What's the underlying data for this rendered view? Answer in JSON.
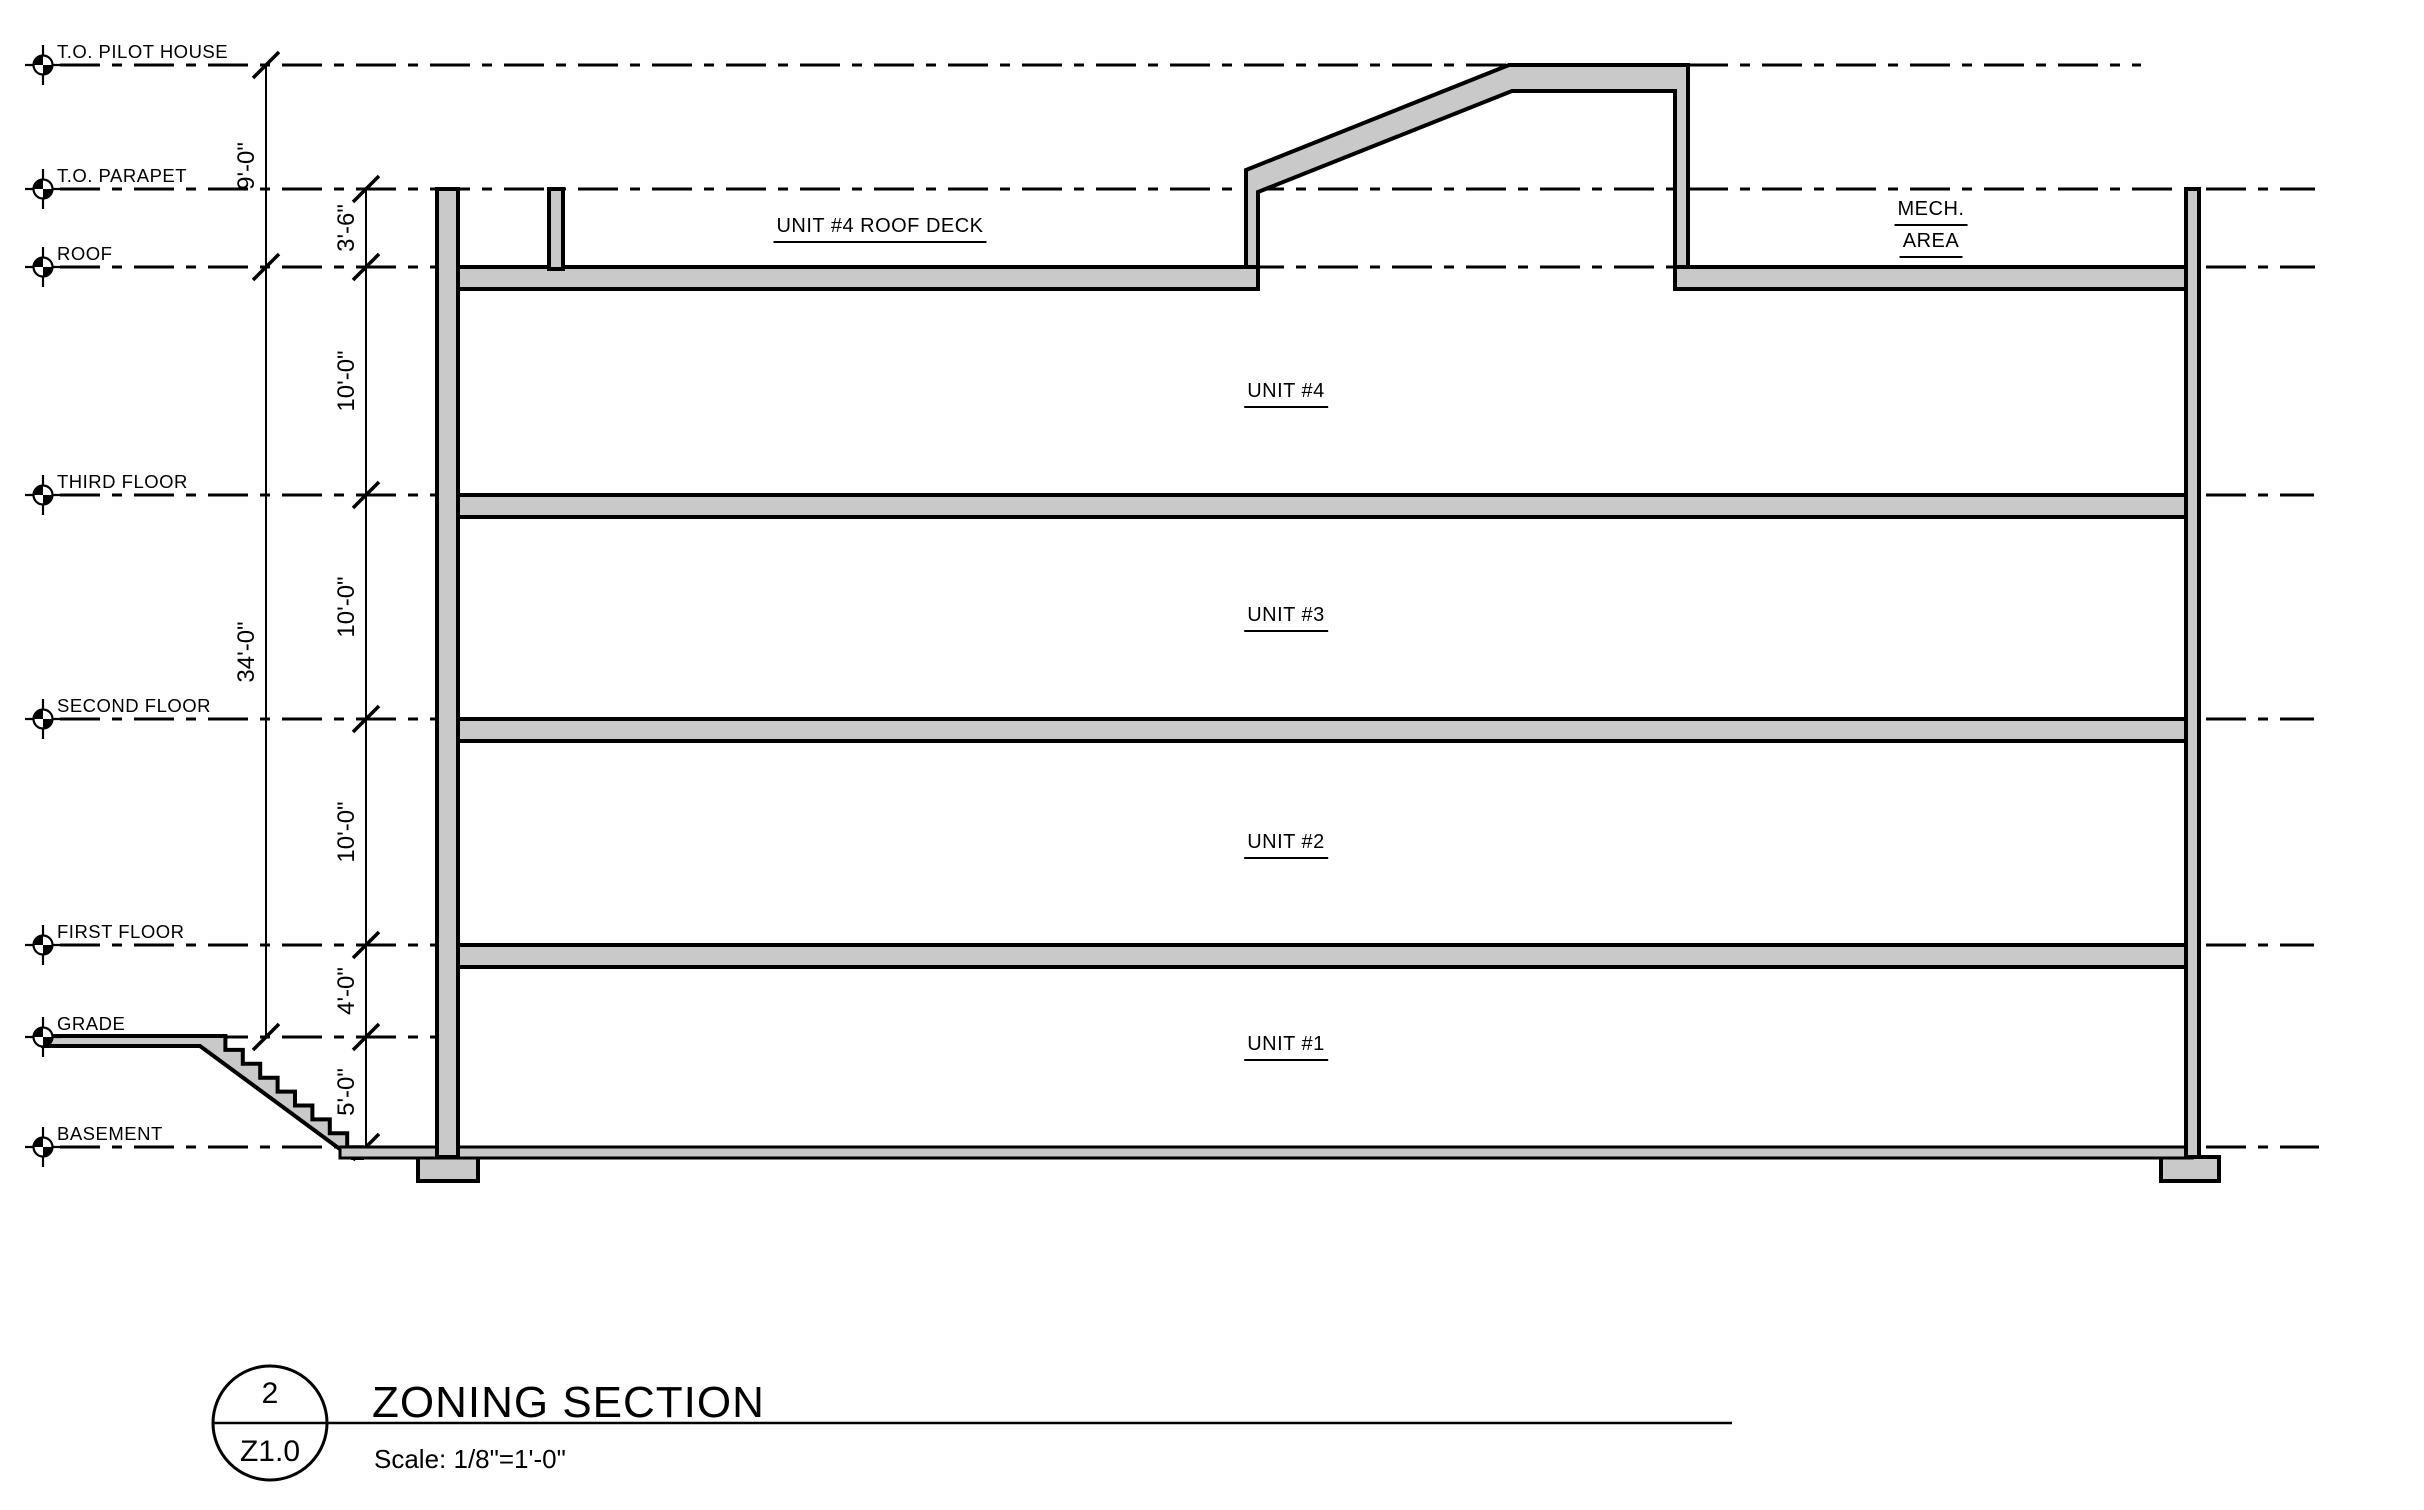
{
  "drawing": {
    "levels": [
      {
        "label": "T.O. PILOT HOUSE"
      },
      {
        "label": "T.O. PARAPET"
      },
      {
        "label": "ROOF"
      },
      {
        "label": "THIRD FLOOR"
      },
      {
        "label": "SECOND FLOOR"
      },
      {
        "label": "FIRST FLOOR"
      },
      {
        "label": "GRADE"
      },
      {
        "label": "BASEMENT"
      }
    ],
    "dimensions": {
      "roof_to_pilot_house": "9'-0\"",
      "grade_to_roof": "34'-0\"",
      "roof_to_parapet": "3'-6\"",
      "third_to_roof": "10'-0\"",
      "second_to_third": "10'-0\"",
      "first_to_second": "10'-0\"",
      "grade_to_first": "4'-0\"",
      "basement_to_grade": "5'-0\""
    },
    "rooms": {
      "roof_deck": "UNIT #4 ROOF DECK",
      "mech_line1": "MECH.",
      "mech_line2": "AREA",
      "unit4": "UNIT #4",
      "unit3": "UNIT #3",
      "unit2": "UNIT #2",
      "unit1": "UNIT #1"
    },
    "colors": {
      "paper": "#ffffff",
      "line": "#000000",
      "wall_fill": "#c9c9c9"
    }
  },
  "titleblock": {
    "detail_number": "2",
    "sheet_number": "Z1.0",
    "title": "ZONING SECTION",
    "scale": "Scale: 1/8\"=1'-0\""
  }
}
